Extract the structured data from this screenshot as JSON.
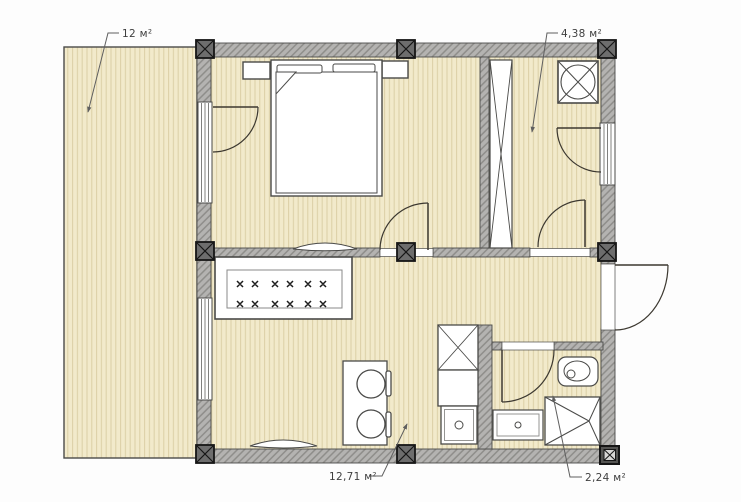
{
  "plan": {
    "title": "floor-plan",
    "labels": {
      "terrace": "12 м²",
      "hall": "4,38 м²",
      "kitchen_living": "12,71 м²",
      "bathroom": "2,24 м²"
    },
    "colors": {
      "background": "#fdfdfd",
      "floor": "#f2eacb",
      "floor_stripe": "#dbcfa5",
      "wall_fill": "#b4b3b1",
      "wall_hatch_line": "#8e8d8a",
      "outline": "#4b4b49",
      "post_fill": "#6d6d6d",
      "door_line": "#3c3830",
      "leader_line": "#5f5f5f",
      "label_text": "#3f3f3f"
    },
    "symbols": [
      "terrace-deck",
      "double-bed",
      "pillow",
      "nightstand",
      "terrace-door",
      "window",
      "wardrobe",
      "extractor-fan",
      "hall-door",
      "entry-door",
      "sofa",
      "wall-shelf",
      "dining-table",
      "stool",
      "kitchen-sink-unit",
      "kitchen-counter",
      "cooker",
      "bathroom-door",
      "washbasin",
      "vanity-cabinet",
      "shower-tray",
      "structural-post"
    ]
  }
}
